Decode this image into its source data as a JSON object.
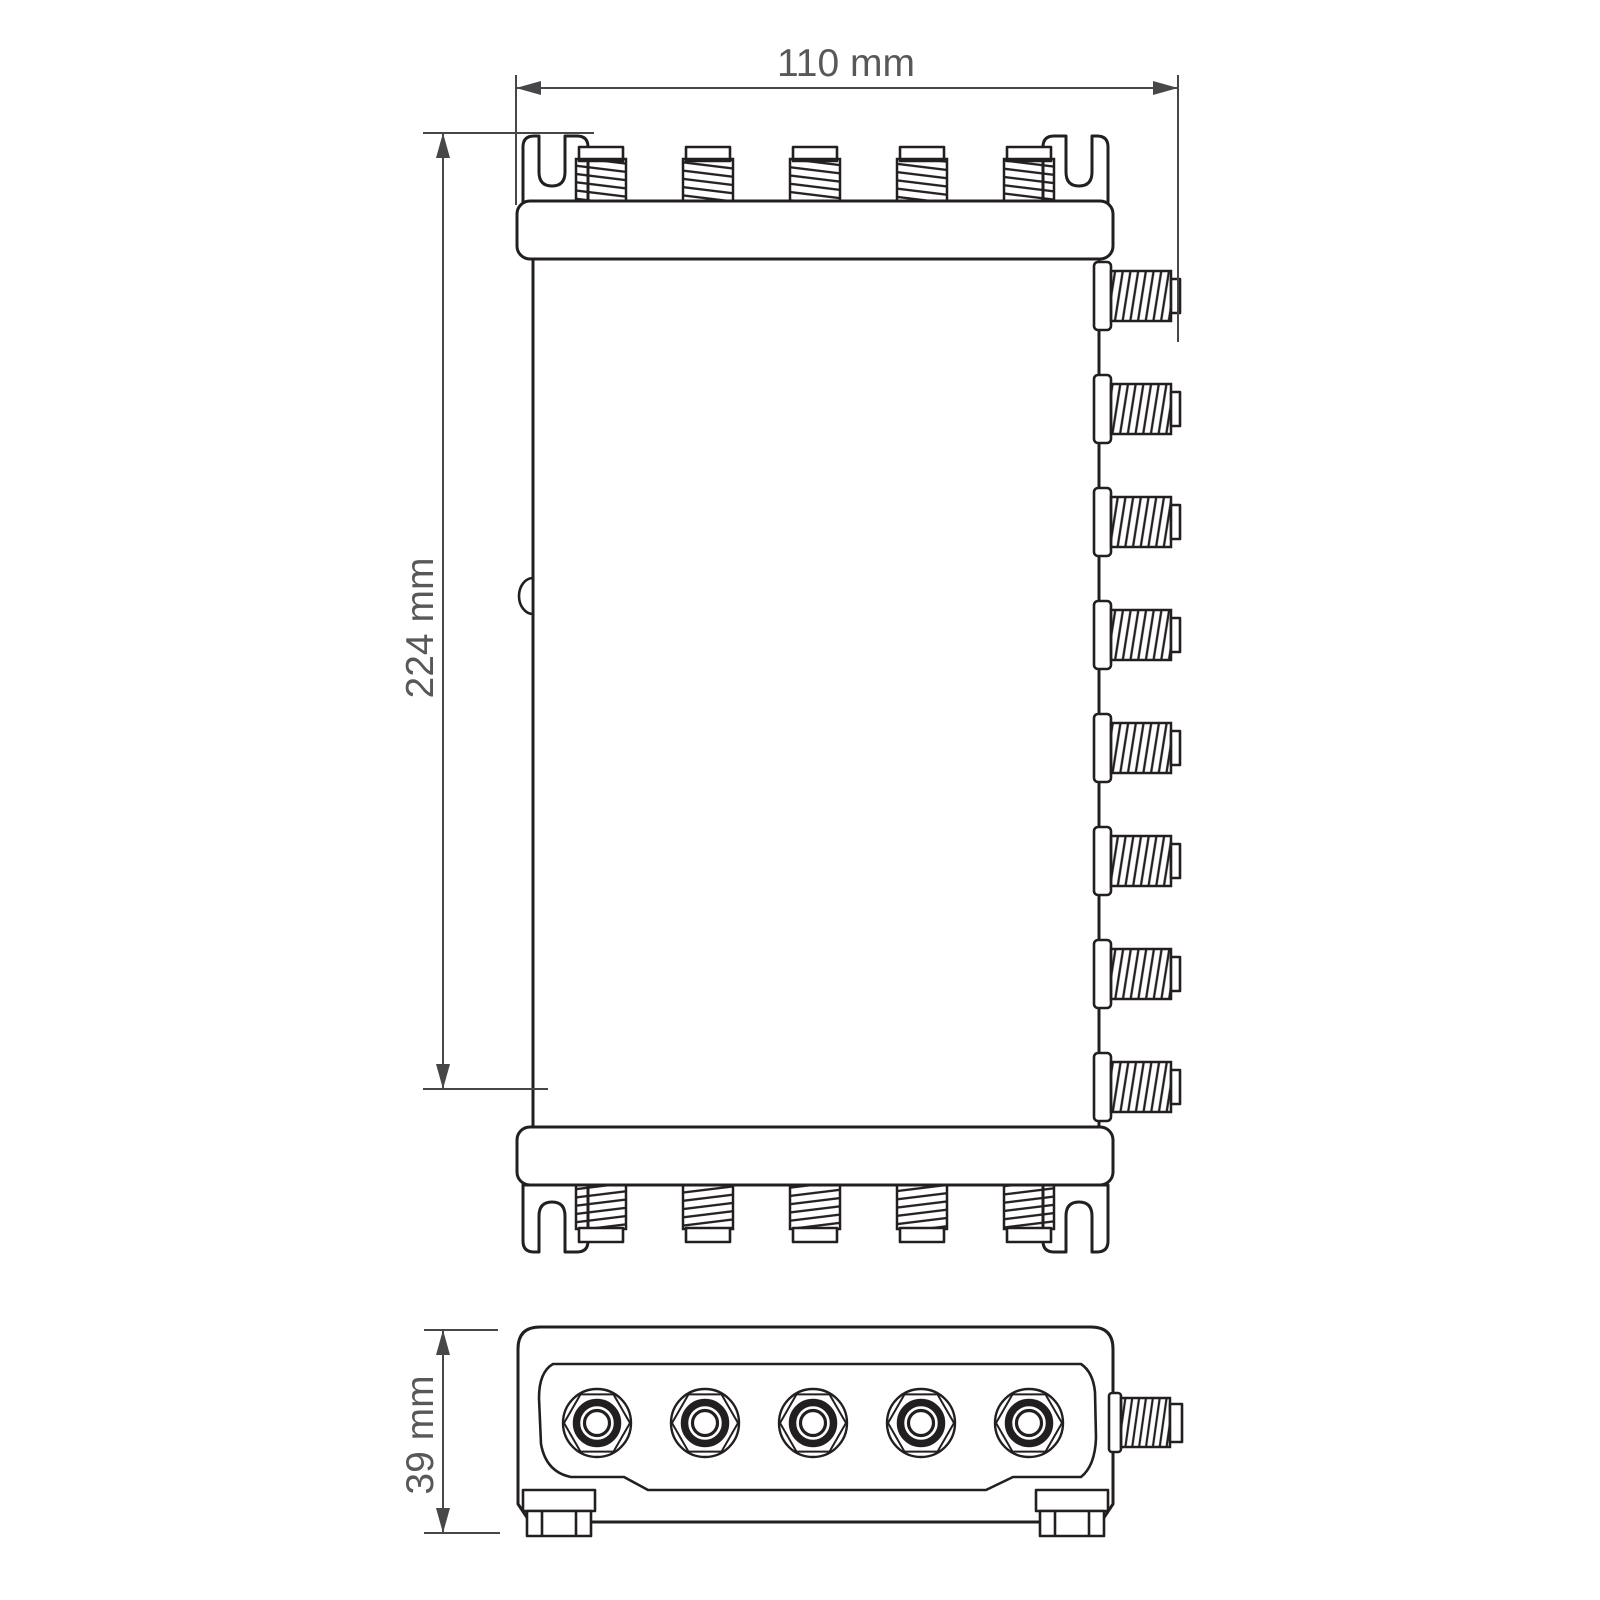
{
  "drawing": {
    "type": "technical-dimension-drawing",
    "dimension_labels": {
      "width": "110 mm",
      "height": "224 mm",
      "depth": "39 mm"
    },
    "views": {
      "front": {
        "top_connector_count": 5,
        "bottom_connector_count": 5,
        "side_connector_count": 8
      },
      "bottom": {
        "port_count": 5,
        "side_connector_count": 1
      }
    },
    "colors": {
      "line": "#231f20",
      "dimension_line": "#47474a",
      "text": "#58585b",
      "fill": "#ffffff"
    }
  }
}
